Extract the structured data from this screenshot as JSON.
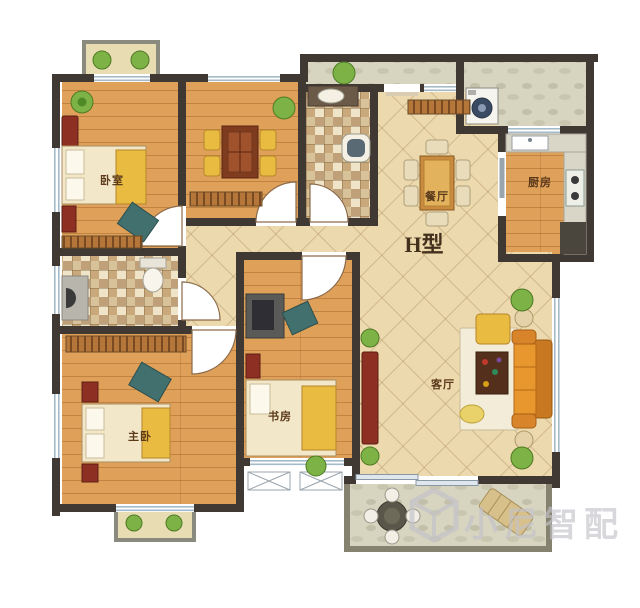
{
  "floor_plan": {
    "layout_type_label": "H型",
    "rooms": {
      "bedroom": {
        "label": "卧室"
      },
      "master_bedroom": {
        "label": "主卧"
      },
      "study": {
        "label": "书房"
      },
      "dining_room": {
        "label": "餐厅"
      },
      "kitchen": {
        "label": "厨房"
      },
      "living_room": {
        "label": "客厅"
      }
    },
    "watermark": {
      "brand_text": "小尼智配"
    },
    "palette": {
      "wall": "#3f3833",
      "wood_floor": "#dfa159",
      "hall_tile": "#ecd9ae",
      "bath_tile": "#d9c49a",
      "balcony_floor": "#d7d4bf",
      "sofa_orange": "#e8962e",
      "accent_red": "#8e2f23",
      "plant_green": "#7db346",
      "window_blue": "#a5bac8"
    }
  }
}
